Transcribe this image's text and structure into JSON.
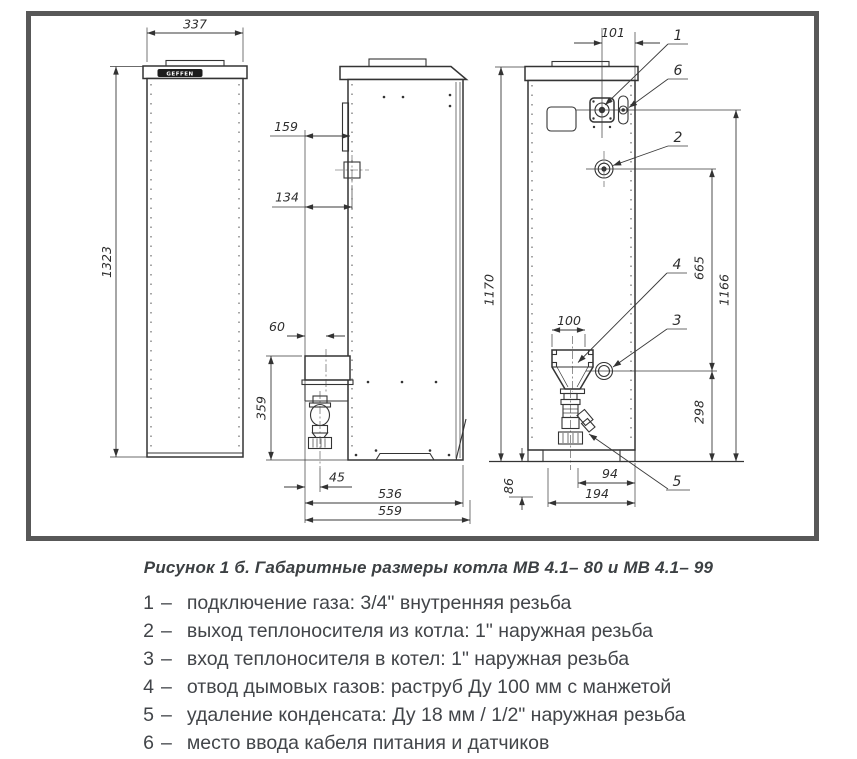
{
  "drawing": {
    "brand_label": "GEFFEN",
    "dims": {
      "front_width": "337",
      "front_height": "1323",
      "side_bracket": "159",
      "side_fitting": "134",
      "box_offset": "60",
      "box_height": "359",
      "siphon_offset": "45",
      "depth_body": "536",
      "depth_total": "559",
      "gas_offset": "101",
      "back_height": "1170",
      "flow_height": "665",
      "gas_height": "1166",
      "return_height": "298",
      "flue_width": "100",
      "condensate_drop": "86",
      "drain_offset": "94",
      "drain_total": "194"
    },
    "callouts": {
      "c1": "1",
      "c2": "2",
      "c3": "3",
      "c4": "4",
      "c5": "5",
      "c6": "6"
    }
  },
  "figure": {
    "caption": "Рисунок 1 б. Габаритные размеры котла МВ 4.1– 80 и МВ 4.1– 99",
    "legend": [
      {
        "num": "1",
        "sep": "–",
        "text": "подключение газа: 3/4\" внутренняя резьба"
      },
      {
        "num": "2",
        "sep": "–",
        "text": "выход теплоносителя из котла: 1\" наружная резьба"
      },
      {
        "num": "3",
        "sep": "–",
        "text": "вход теплоносителя в котел: 1\" наружная резьба"
      },
      {
        "num": "4",
        "sep": "–",
        "text": "отвод дымовых газов: раструб Ду 100 мм с манжетой"
      },
      {
        "num": "5",
        "sep": "–",
        "text": "удаление конденсата: Ду 18 мм / 1/2\" наружная резьба"
      },
      {
        "num": "6",
        "sep": "–",
        "text": "место ввода кабеля питания и датчиков"
      }
    ]
  }
}
